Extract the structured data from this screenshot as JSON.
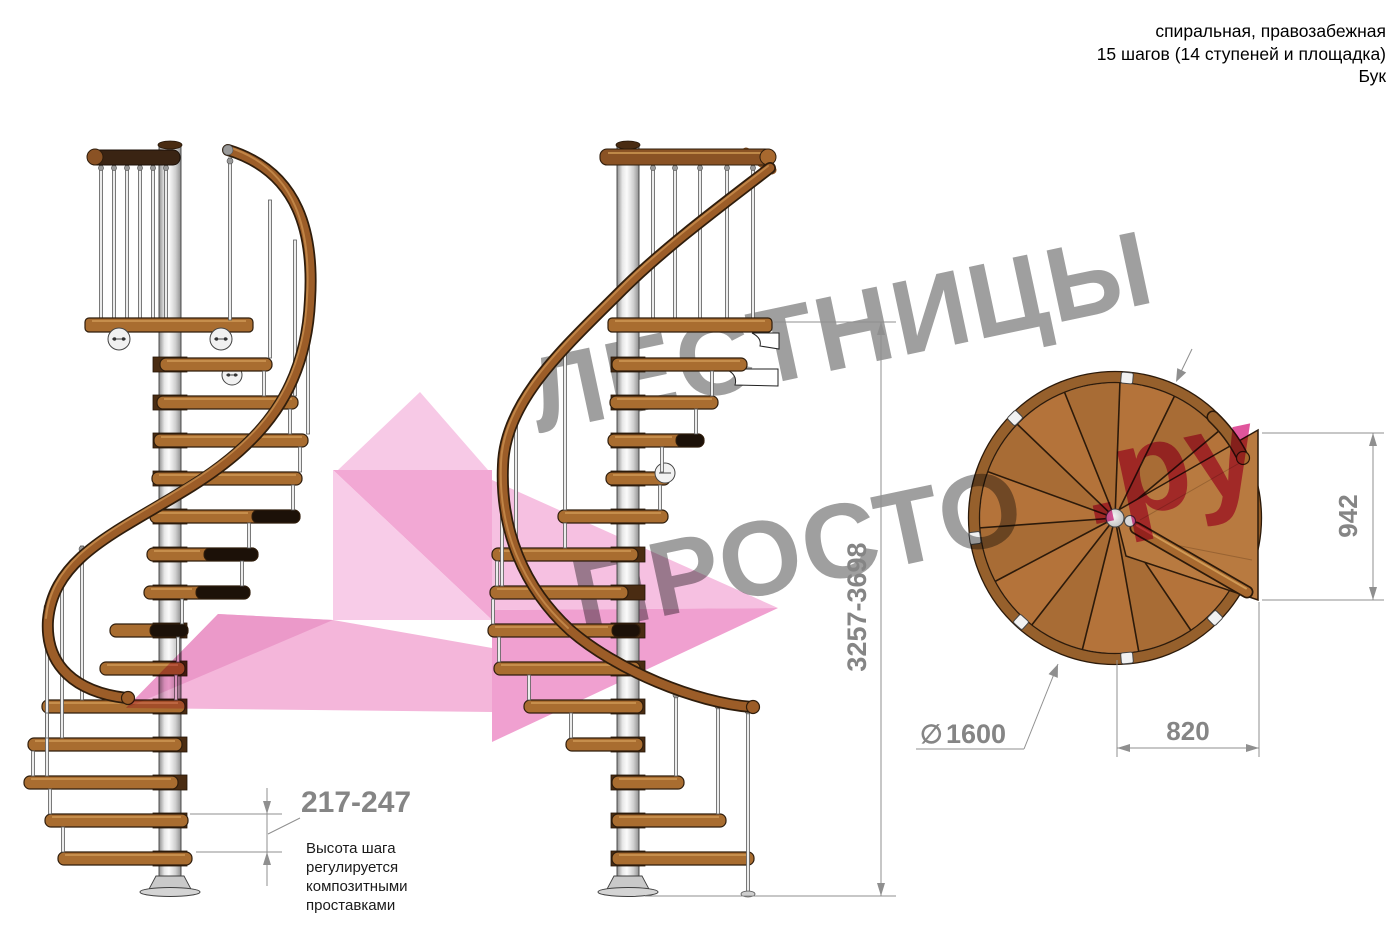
{
  "header": {
    "line1": "спиральная, правозабежная",
    "line2": "15 шагов (14 ступеней и площадка)",
    "line3": "Бук"
  },
  "watermark": {
    "line1": "ЛЕСТНИЦЫ",
    "line2": "ПРОСТО",
    "suffix": ".ру"
  },
  "dimensions": {
    "step_height": "217-247",
    "note_lines": [
      "Высота шага",
      "регулируется",
      "композитными",
      "проставками"
    ],
    "total_height": "3257-3698",
    "plan_width": "942",
    "plan_depth": "820",
    "diameter_symbol": "∅",
    "diameter_value": "1600"
  },
  "colors": {
    "wood": "#a96d30",
    "wood_dark": "#2f1d0c",
    "handrail": "#9c5d28",
    "pole": "#d9d9d9",
    "dimension_gray": "#858585",
    "watermark_gray": "#9f9f9f",
    "watermark_pink": "#e0559c",
    "arrow_pink": "#f4b6da"
  }
}
